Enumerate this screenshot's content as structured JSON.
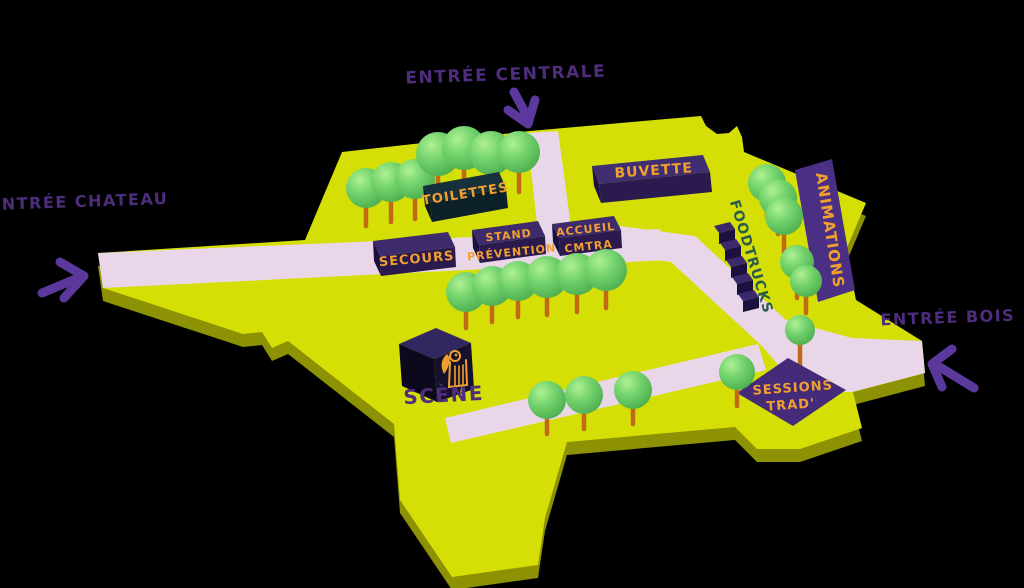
{
  "map": {
    "colors": {
      "background": "#000000",
      "field": "#d5df06",
      "field_side": "#8d9104",
      "path": "#e9d7e9",
      "box_top": "#3e2b6b",
      "box_front": "#2a1a4e",
      "box_side": "#1c1040",
      "dark_box_top": "#16313c",
      "dark_box_front": "#0c2029",
      "dark_box_side": "#091a22",
      "scene_top": "#332762",
      "scene_front": "#16122b",
      "scene_side": "#0c091d",
      "animations_band": "#4b2f85",
      "sessions_diamond": "#432b7a",
      "orange_text": "#f1a02f",
      "purple_text": "#4f2d7d",
      "arrow_purple": "#5a389c",
      "foodtrucks_text": "#2a5c4b",
      "trunk": "#c06a15",
      "cube_top": "#3b2a6b",
      "cube_front": "#1c1040"
    },
    "entrances": {
      "central": "ENTRÉE CENTRALE",
      "chateau": "ENTRÉE CHATEAU",
      "bois": "ENTRÉE BOIS"
    },
    "locations": {
      "buvette": "BUVETTE",
      "toilettes": "TOILETTES",
      "secours": "SECOURS",
      "stand_prevention": {
        "line1": "STAND",
        "line2": "PRÉVENTION"
      },
      "accueil": {
        "line1": "ACCUEIL",
        "line2": "CMTRA"
      },
      "foodtrucks": "FOODTRUCKS",
      "animations": "ANIMATIONS",
      "sessions_trad": {
        "line1": "SESSIONS",
        "line2": "TRAD'"
      },
      "scene": "SCÈNE"
    },
    "trees": [
      {
        "x": 366,
        "y": 188,
        "r": 20,
        "t": 38,
        "layer": "topback"
      },
      {
        "x": 391,
        "y": 182,
        "r": 20,
        "t": 40,
        "layer": "topback"
      },
      {
        "x": 415,
        "y": 179,
        "r": 20,
        "t": 40,
        "layer": "topback"
      },
      {
        "x": 438,
        "y": 154,
        "r": 22,
        "t": 42,
        "layer": "topback"
      },
      {
        "x": 464,
        "y": 148,
        "r": 22,
        "t": 42,
        "layer": "topback"
      },
      {
        "x": 491,
        "y": 153,
        "r": 22,
        "t": 42,
        "layer": "topback"
      },
      {
        "x": 519,
        "y": 152,
        "r": 21,
        "t": 40,
        "layer": "topback"
      },
      {
        "x": 466,
        "y": 292,
        "r": 20,
        "t": 36,
        "layer": "mid"
      },
      {
        "x": 492,
        "y": 286,
        "r": 20,
        "t": 36,
        "layer": "mid"
      },
      {
        "x": 518,
        "y": 281,
        "r": 20,
        "t": 36,
        "layer": "mid"
      },
      {
        "x": 547,
        "y": 277,
        "r": 21,
        "t": 38,
        "layer": "mid"
      },
      {
        "x": 577,
        "y": 274,
        "r": 21,
        "t": 38,
        "layer": "mid"
      },
      {
        "x": 606,
        "y": 270,
        "r": 21,
        "t": 38,
        "layer": "mid"
      },
      {
        "x": 547,
        "y": 400,
        "r": 19,
        "t": 34,
        "layer": "bottom"
      },
      {
        "x": 584,
        "y": 395,
        "r": 19,
        "t": 34,
        "layer": "bottom"
      },
      {
        "x": 633,
        "y": 390,
        "r": 19,
        "t": 34,
        "layer": "bottom"
      },
      {
        "x": 767,
        "y": 183,
        "r": 19,
        "t": 34,
        "layer": "right"
      },
      {
        "x": 778,
        "y": 198,
        "r": 19,
        "t": 36,
        "layer": "right"
      },
      {
        "x": 784,
        "y": 216,
        "r": 19,
        "t": 42,
        "layer": "right"
      },
      {
        "x": 797,
        "y": 262,
        "r": 17,
        "t": 36,
        "layer": "right"
      },
      {
        "x": 806,
        "y": 281,
        "r": 16,
        "t": 32,
        "layer": "right"
      },
      {
        "x": 800,
        "y": 330,
        "r": 15,
        "t": 36,
        "layer": "right"
      },
      {
        "x": 737,
        "y": 372,
        "r": 18,
        "t": 34,
        "layer": "sessions"
      }
    ],
    "foodtruck_cubes": [
      {
        "x": 714,
        "y": 226
      },
      {
        "x": 720,
        "y": 243
      },
      {
        "x": 726,
        "y": 260
      },
      {
        "x": 732,
        "y": 277
      },
      {
        "x": 738,
        "y": 294
      }
    ]
  }
}
